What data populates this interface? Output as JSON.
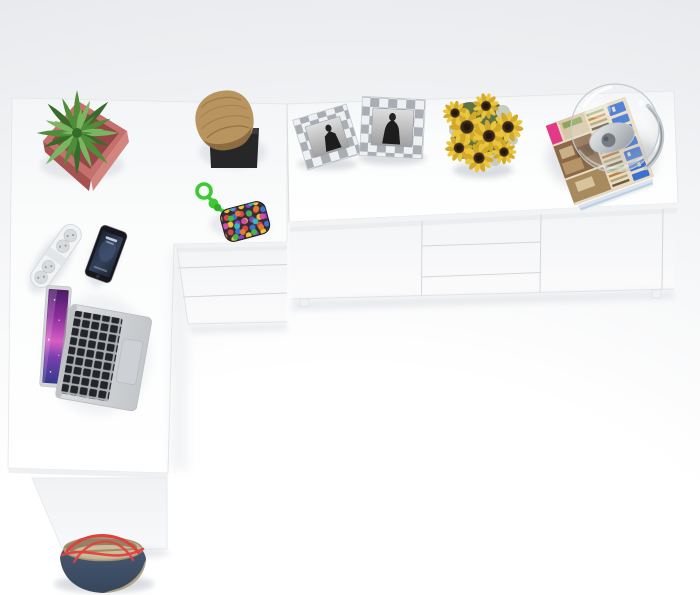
{
  "meta": {
    "description": "Top-down product photo of a white L-shaped corner desk joined to a low white sideboard, styled with accessories; a blue canvas bag sits on the floor by the desk leg."
  },
  "furniture": {
    "desk": {
      "label": "white corner desk",
      "pedestal_drawers": 3
    },
    "sideboard": {
      "label": "white low sideboard",
      "front_sections": [
        "door",
        "three drawers",
        "door"
      ],
      "visible_feet": 2
    }
  },
  "items": [
    {
      "name": "potted-plant",
      "label": "speckled green plant in rose-pink square pot"
    },
    {
      "name": "log-ornament",
      "label": "natural wood log on black square plinth"
    },
    {
      "name": "bead-pouch",
      "label": "multicolour beaded pouch with knotted green rope"
    },
    {
      "name": "photo-frame-left",
      "label": "checkered silver frame, black-and-white portrait"
    },
    {
      "name": "photo-frame-right",
      "label": "checkered silver frame, black-and-white portrait"
    },
    {
      "name": "sunflower-bouquet",
      "label": "sunflower bouquet in glass vase"
    },
    {
      "name": "magazine-stack",
      "label": "stack of interior magazines, blue title lettering (illegible)"
    },
    {
      "name": "glass-dome-lamp",
      "label": "clear glass globe lamp with metal reflector on magazines"
    },
    {
      "name": "power-strip",
      "label": "white power strip with round sockets"
    },
    {
      "name": "smartphone",
      "label": "black smartphone with dark lock screen"
    },
    {
      "name": "laptop",
      "label": "open silver laptop, purple galaxy wallpaper, black keys"
    },
    {
      "name": "handbag",
      "label": "blue canvas bag with red straps and khaki trim"
    }
  ],
  "colors": {
    "bgOuter": "#e7e9ec",
    "bgMid": "#f2f3f5",
    "bgInner": "#ffffff",
    "surfaceEdge": "#e3e5e8",
    "seamGrey": "#d3d6da",
    "shadowSoft": "#dfe2e6",
    "potPink": "#c4706d",
    "potDeep": "#a65251",
    "potRim": "#8e4342",
    "potLight": "#d2857f",
    "leafGreen": "#4f8d39",
    "leafLight": "#79b65f",
    "leafDeep": "#376b2b",
    "woodTan": "#b8955f",
    "woodDeep": "#8d6c41",
    "plinthBlack": "#272727",
    "ropeGreen": "#3ec934",
    "pouchBase": "#332c31",
    "frameSilver": "#a9aeb4",
    "frameWhite": "#eef0f2",
    "figureBlack": "#1d1d1d",
    "petalYellow": "#eac63e",
    "petalDeep": "#d4a928",
    "discBrown": "#39291b",
    "foliageGreen": "#5f7243",
    "foliagePale": "#c6ccc0",
    "vaseGrey": "#dfe3e5",
    "coverBeige": "#e9dcc2",
    "coverBrown": "#8a6848",
    "coverTan": "#bb9e73",
    "accentPink": "#e23a86",
    "titleBlue": "#3a70d2",
    "glassRim": "#c4c9cd",
    "metalGrey": "#9aa0a6",
    "metalDeep": "#60656b",
    "metalLight": "#eceef0",
    "stripWhite": "#f1f2f4",
    "socketGrey": "#d8dbde",
    "socketHole": "#9aa0a5",
    "phoneBlack": "#17181c",
    "bodySilver": "#d6d8da",
    "keyBlack": "#232529",
    "padGrey": "#cdd0d4",
    "bagDenim": "#46566e",
    "bagDenimDeep": "#394b63",
    "bagKhaki": "#c3b291",
    "bagKhakiDeep": "#8a7a5e",
    "strapRed": "#e2403e"
  }
}
